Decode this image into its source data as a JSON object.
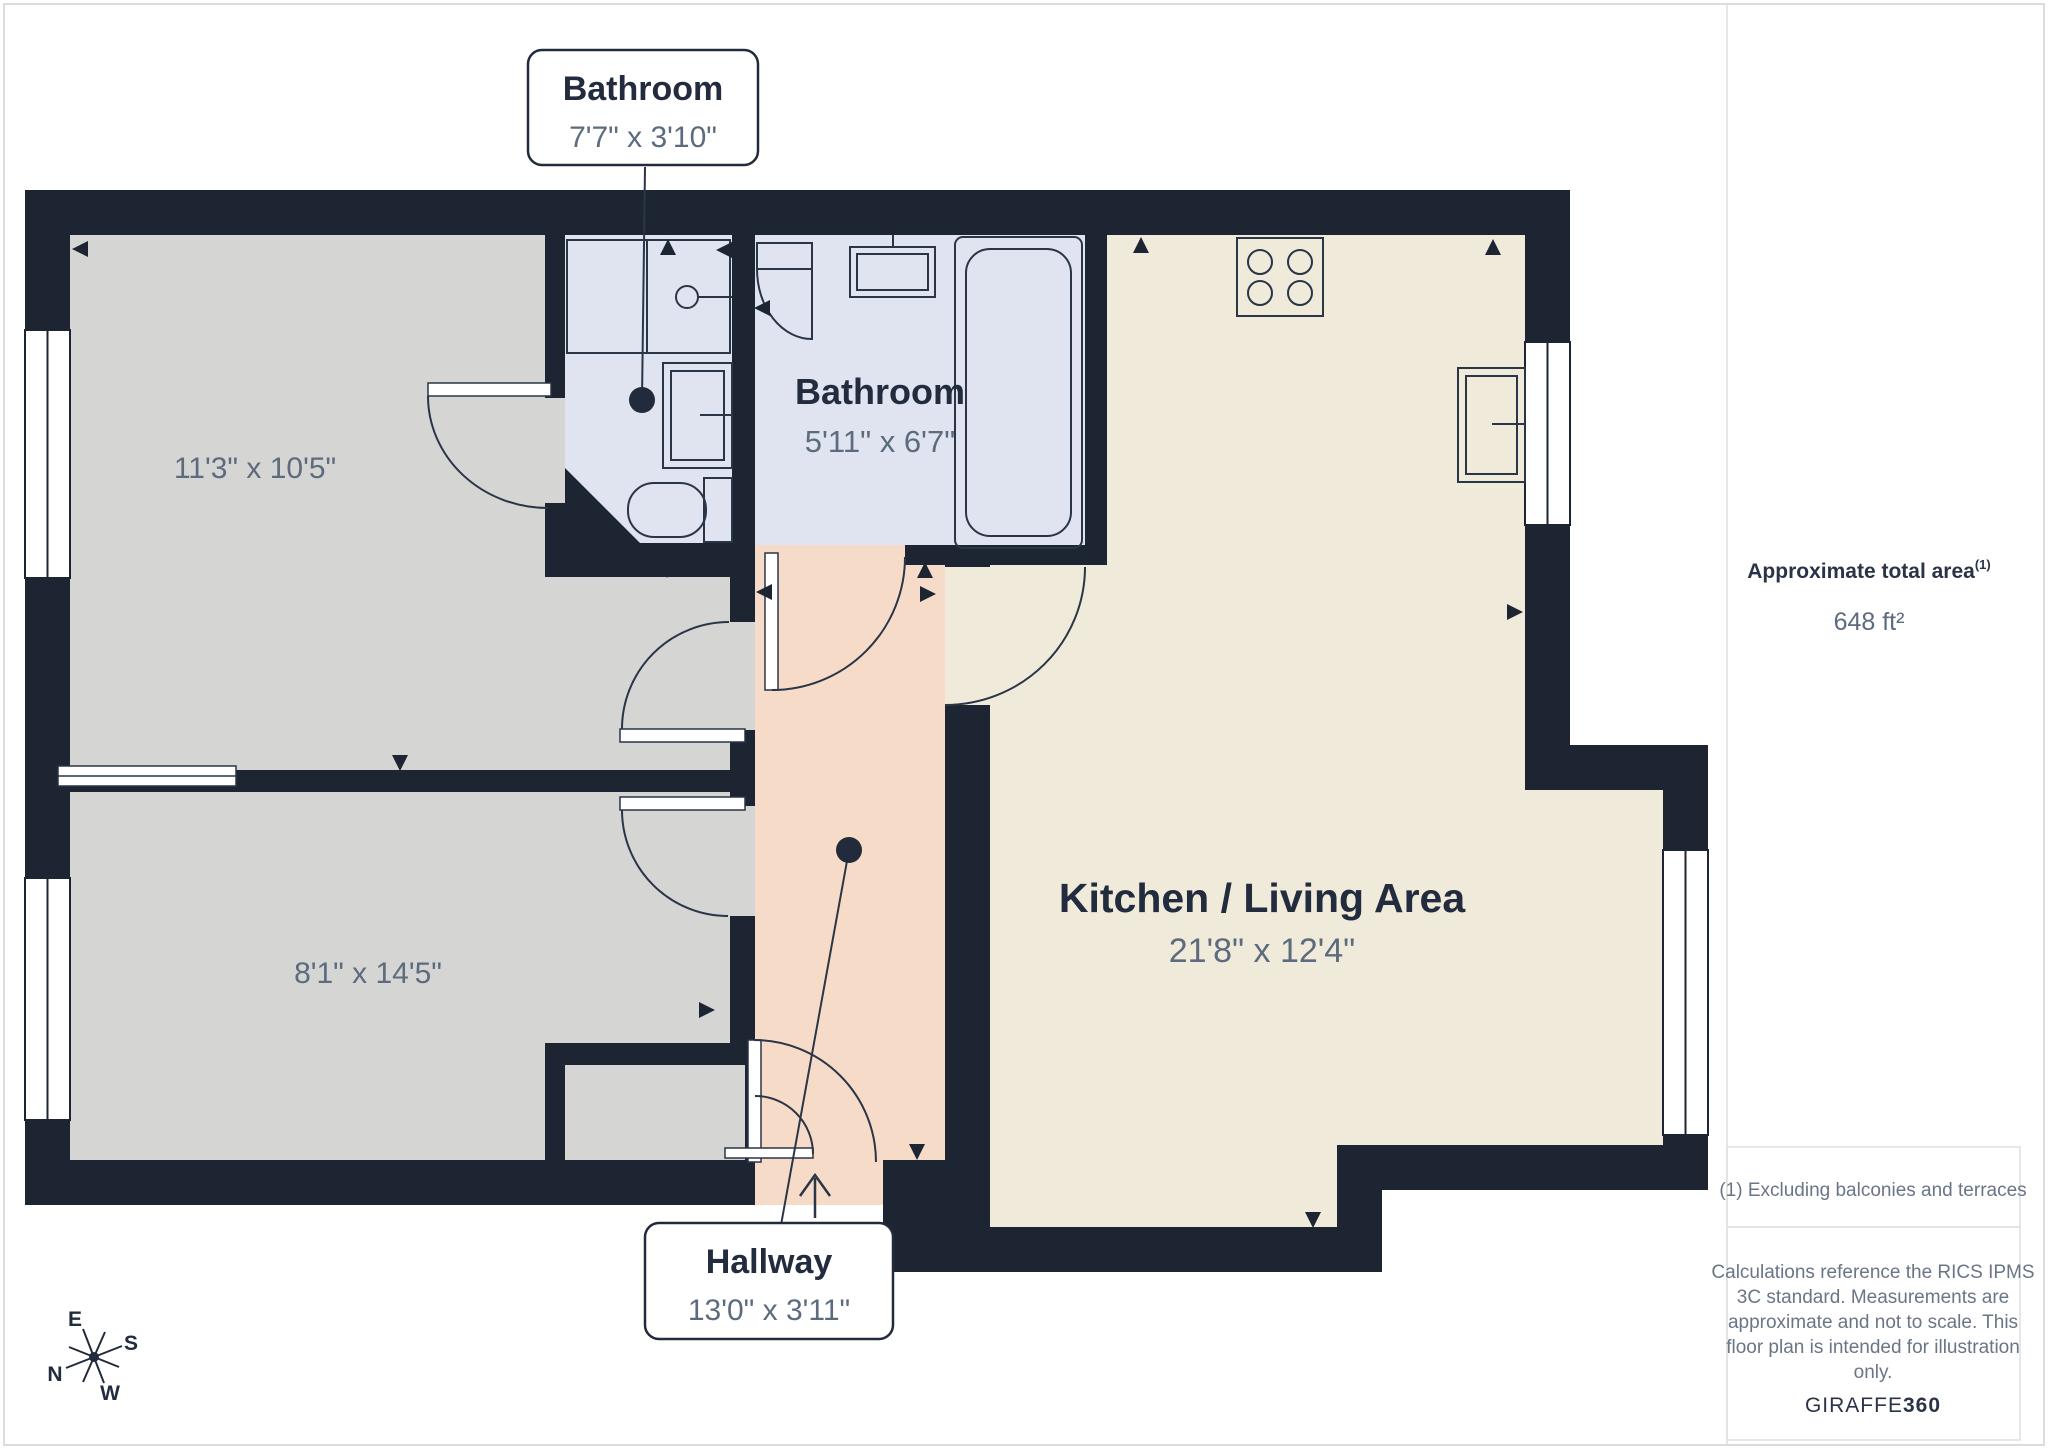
{
  "colors": {
    "wall": "#1D2533",
    "room_gray": "#D5D5D3",
    "bath_blue": "#DFE4F0",
    "kitchen_cream": "#F0EADA",
    "hallway_peach": "#F6DCC8",
    "label_dark": "#232C3E",
    "label_gray": "#5D6B7E",
    "border_gray": "#DCDCDC"
  },
  "floorplan": {
    "bedroom1_dims": "11'3\" x 10'5\"",
    "bedroom2_dims": "8'1\" x 14'5\"",
    "bathroom_small": {
      "name": "Bathroom",
      "dims": "7'7\" x 3'10\""
    },
    "bathroom_main": {
      "name": "Bathroom",
      "dims": "5'11\" x 6'7\""
    },
    "kitchen": {
      "name": "Kitchen / Living Area",
      "dims": "21'8\" x 12'4\""
    },
    "hallway": {
      "name": "Hallway",
      "dims": "13'0\" x 3'11\""
    },
    "compass": {
      "e": "E",
      "s": "S",
      "n": "N",
      "w": "W"
    }
  },
  "sidebar": {
    "total_area_label": "Approximate total area",
    "total_area_note_ref": "(1)",
    "total_area_value": "648 ft²",
    "footnote": "(1) Excluding balconies and terraces",
    "disclaimer_lines": [
      "Calculations reference the RICS IPMS",
      "3C standard. Measurements are",
      "approximate and not to scale. This",
      "floor plan is intended for illustration",
      "only."
    ],
    "brand_name": "GIRAFFE",
    "brand_suffix": "360"
  }
}
